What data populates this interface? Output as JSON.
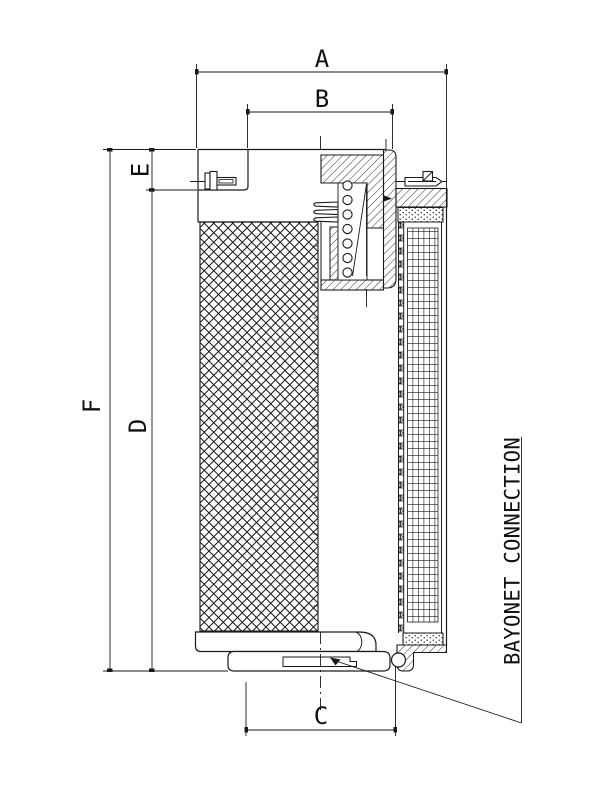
{
  "drawing": {
    "dimension_labels": {
      "a": "A",
      "b": "B",
      "c": "C",
      "d": "D",
      "e": "E",
      "f": "F"
    },
    "callout": {
      "text": "BAYONET CONNECTION"
    },
    "colors": {
      "line": "#1a1a1a",
      "background": "#ffffff"
    }
  }
}
